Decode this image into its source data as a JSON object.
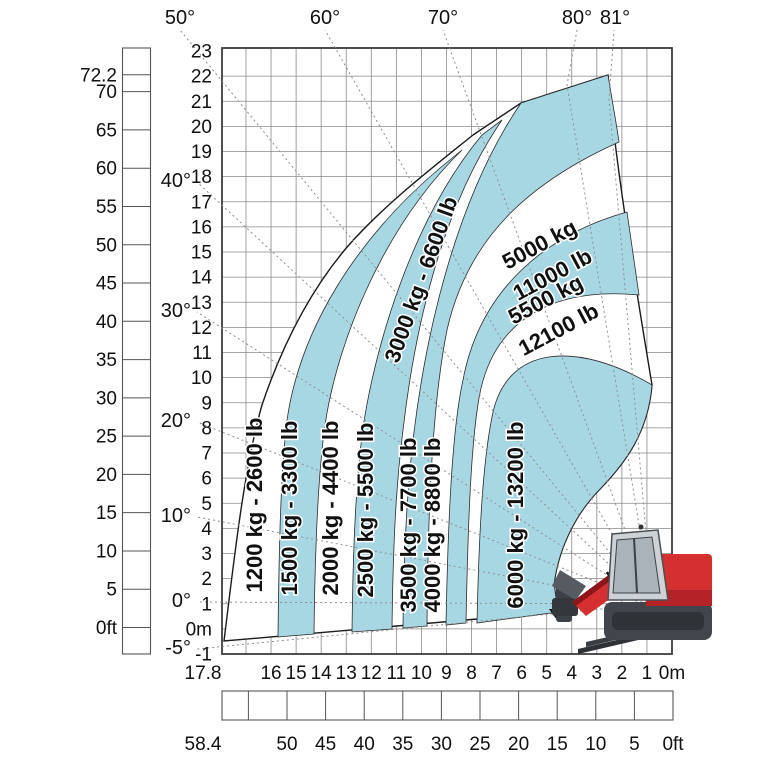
{
  "colors": {
    "band_blue": "#a8d7e4",
    "machine_red": "#d62f2f",
    "grid_gray": "#8a8a8a"
  },
  "axes": {
    "height_ft": [
      "72.2",
      "70",
      "65",
      "60",
      "55",
      "50",
      "45",
      "40",
      "35",
      "30",
      "25",
      "20",
      "15",
      "10",
      "5",
      "0ft"
    ],
    "height_m": [
      "23",
      "22",
      "21",
      "20",
      "19",
      "18",
      "17",
      "16",
      "15",
      "14",
      "13",
      "12",
      "11",
      "10",
      "9",
      "8",
      "7",
      "6",
      "5",
      "4",
      "3",
      "2",
      "1",
      "0m",
      "-1"
    ],
    "reach_m": [
      "17.8",
      "16",
      "15",
      "14",
      "13",
      "12",
      "11",
      "10",
      "9",
      "8",
      "7",
      "6",
      "5",
      "4",
      "3",
      "2",
      "1",
      "0m"
    ],
    "reach_ft": [
      "58.4",
      "50",
      "45",
      "40",
      "35",
      "30",
      "25",
      "20",
      "15",
      "10",
      "5",
      "0ft"
    ],
    "angles_top": [
      "50°",
      "60°",
      "70°",
      "80°",
      "81°"
    ],
    "angles_left": [
      "40°",
      "30°",
      "20°",
      "10°",
      "0°",
      "-5°"
    ]
  },
  "zones": [
    {
      "kg": 1200,
      "lb": 2600,
      "label": "1200 kg - 2600 lb",
      "color": "white"
    },
    {
      "kg": 1500,
      "lb": 3300,
      "label": "1500 kg - 3300 lb",
      "color": "blue"
    },
    {
      "kg": 2000,
      "lb": 4400,
      "label": "2000 kg - 4400 lb",
      "color": "white"
    },
    {
      "kg": 2500,
      "lb": 5500,
      "label": "2500 kg - 5500 lb",
      "color": "blue"
    },
    {
      "kg": 3000,
      "lb": 6600,
      "label": "3000 kg - 6600 lb",
      "color": "white"
    },
    {
      "kg": 3500,
      "lb": 7700,
      "label": "3500 kg - 7700 lb",
      "color": "blue"
    },
    {
      "kg": 4000,
      "lb": 8800,
      "label": "4000 kg - 8800 lb",
      "color": "white"
    },
    {
      "kg": 5000,
      "lb": 11000,
      "label_lines": [
        "5000 kg",
        "11000 lb"
      ],
      "color": "blue"
    },
    {
      "kg": 5500,
      "lb": 12100,
      "label_lines": [
        "5500 kg",
        "12100 lb"
      ],
      "color": "white"
    },
    {
      "kg": 6000,
      "lb": 13200,
      "label": "6000 kg - 13200 lb",
      "color": "blue"
    }
  ],
  "machine": {
    "brand_letter": "M"
  },
  "chart_data": {
    "type": "area",
    "title": "Telehandler load capacity chart (lift height vs. forward reach)",
    "xlabel": "reach (m above, ft below)",
    "ylabel": "lift height (ft left, m right)",
    "x_range_m": [
      0,
      17.8
    ],
    "x_range_ft": [
      0,
      58.4
    ],
    "y_range_m": [
      -1,
      23
    ],
    "y_range_ft": [
      0,
      72.2
    ],
    "max_lift_height_m": 22,
    "max_reach_m": 17.8,
    "boom_angles_deg": [
      -5,
      0,
      10,
      20,
      30,
      40,
      50,
      60,
      70,
      80,
      81
    ],
    "capacity_zones_kg": [
      1200,
      1500,
      2000,
      2500,
      3000,
      3500,
      4000,
      5000,
      5500,
      6000
    ],
    "capacity_zones_lb": [
      2600,
      3300,
      4400,
      5500,
      6600,
      7700,
      8800,
      11000,
      12100,
      13200
    ],
    "legend": "alternating white / light-blue radial bands, higher capacity closer to machine",
    "grid": true
  }
}
